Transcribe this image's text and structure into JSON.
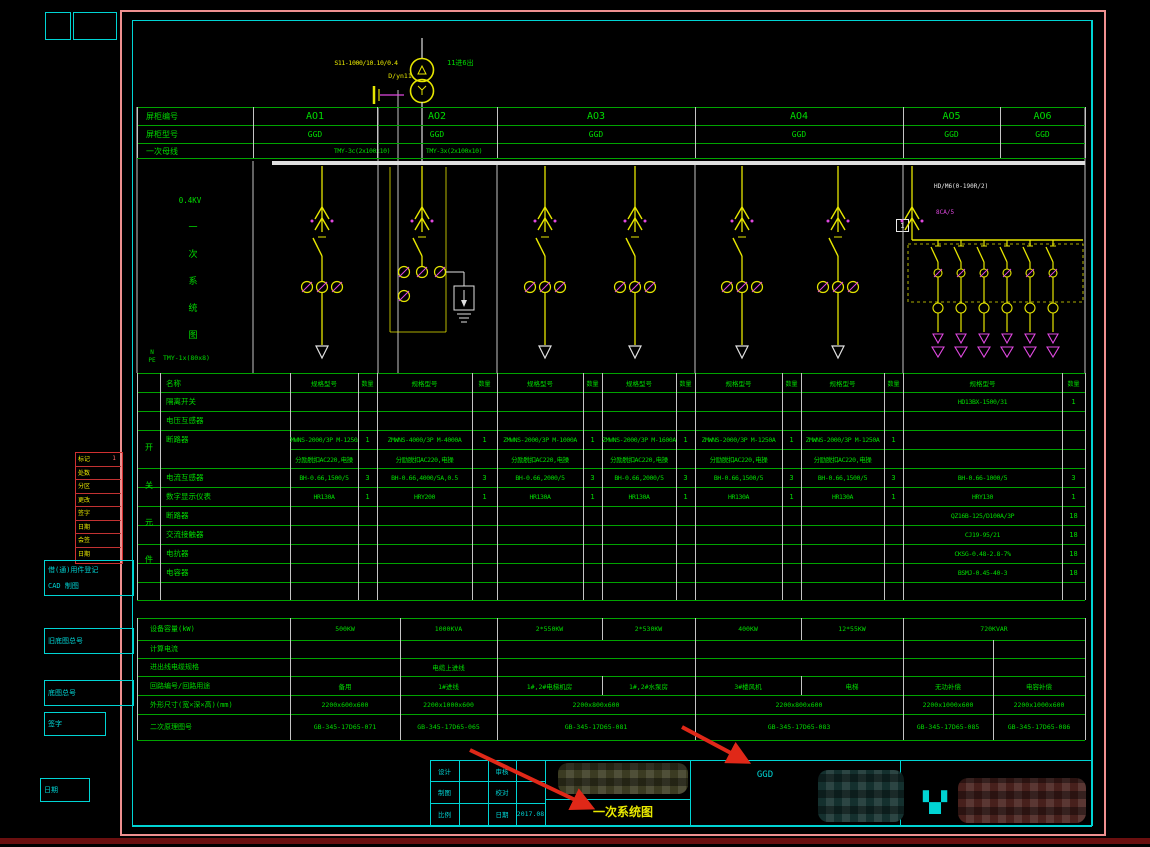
{
  "top": {
    "transformer_model": "S11-1000/10.10/0.4",
    "vector_group": "D/yn11",
    "side_note": "11进6出"
  },
  "left_labels": {
    "voltage": "0.4KV",
    "vertical_title": "一次系统图",
    "n": "N",
    "pe": "PE",
    "npe_bus": "TMY-1x(80x8)"
  },
  "header": {
    "row1_label": "屏柜编号",
    "row2_label": "屏柜型号",
    "row3_label": "一次母线",
    "panels": [
      "AO1",
      "AO2",
      "AO3",
      "AO4",
      "AO5",
      "AO6"
    ],
    "types": [
      "GGD",
      "GGD",
      "GGD",
      "GGD",
      "GGD",
      "GGD"
    ],
    "bus_label_left": "TMY-3c(2x100x10)",
    "bus_label_right": "TMY-3x(2x100x10)"
  },
  "cap_section": {
    "label_model": "HD/M6(0-190R/2)",
    "label_ct": "8CA/5",
    "box_no": "1"
  },
  "equipment": {
    "name_header": "名称",
    "spec_header": "规格型号",
    "qty_header": "数量",
    "group_chars": [
      "开",
      "关",
      "元",
      "件"
    ],
    "rows": [
      {
        "label": "隔离开关",
        "spec": [
          "",
          "",
          "",
          "",
          "",
          "",
          "HD13BX-1500/31"
        ],
        "qty": [
          "",
          "",
          "",
          "",
          "",
          "",
          "1"
        ]
      },
      {
        "label": "电压互感器",
        "spec": [
          "",
          "",
          "",
          "",
          "",
          "",
          ""
        ],
        "qty": [
          "",
          "",
          "",
          "",
          "",
          "",
          ""
        ]
      },
      {
        "label": "断路器",
        "spec": [
          "ZMWNS-2000/3P M-1250A",
          "ZMWNS-4000/3P M-4000A",
          "ZMWNS-2000/3P M-1000A",
          "ZMWNS-2000/3P M-1600A",
          "ZMWNS-2000/3P M-1250A",
          "ZMWNS-2000/3P M-1250A",
          ""
        ],
        "qty": [
          "1",
          "1",
          "1",
          "1",
          "1",
          "1",
          ""
        ]
      },
      {
        "label": "",
        "spec": [
          "分励脱扣AC220,电操",
          "分励脱扣AC220,电操",
          "分励脱扣AC220,电操",
          "分励脱扣AC220,电操",
          "分励脱扣AC220,电操",
          "分励脱扣AC220,电操",
          ""
        ],
        "qty": [
          "",
          "",
          "",
          "",
          "",
          "",
          ""
        ]
      },
      {
        "label": "电流互感器",
        "spec": [
          "BH-0.66,1500/5",
          "BH-0.66,4000/5A,0.5",
          "BH-0.66,2000/5",
          "BH-0.66,2000/5",
          "BH-0.66,1500/5",
          "BH-0.66,1500/5",
          "BH-0.66-1000/5"
        ],
        "qty": [
          "3",
          "3",
          "3",
          "3",
          "3",
          "3",
          "3"
        ]
      },
      {
        "label": "数字显示仪表",
        "spec": [
          "HR130A",
          "HRY200",
          "HR130A",
          "HR130A",
          "HR130A",
          "HR130A",
          "HRY130"
        ],
        "qty": [
          "1",
          "1",
          "1",
          "1",
          "1",
          "1",
          "1"
        ]
      },
      {
        "label": "断路器",
        "spec": [
          "",
          "",
          "",
          "",
          "",
          "",
          "QZ16B-125/D100A/3P"
        ],
        "qty": [
          "",
          "",
          "",
          "",
          "",
          "",
          "18"
        ]
      },
      {
        "label": "交流接触器",
        "spec": [
          "",
          "",
          "",
          "",
          "",
          "",
          "CJ19-95/21"
        ],
        "qty": [
          "",
          "",
          "",
          "",
          "",
          "",
          "18"
        ]
      },
      {
        "label": "电抗器",
        "spec": [
          "",
          "",
          "",
          "",
          "",
          "",
          "CKSG-0.48-2.8-7%"
        ],
        "qty": [
          "",
          "",
          "",
          "",
          "",
          "",
          "18"
        ]
      },
      {
        "label": "电容器",
        "spec": [
          "",
          "",
          "",
          "",
          "",
          "",
          "BSMJ-0.45-40-3"
        ],
        "qty": [
          "",
          "",
          "",
          "",
          "",
          "",
          "18"
        ]
      },
      {
        "label": "",
        "spec": [
          "",
          "",
          "",
          "",
          "",
          "",
          ""
        ],
        "qty": [
          "",
          "",
          "",
          "",
          "",
          "",
          ""
        ]
      }
    ]
  },
  "summary": {
    "rows": [
      {
        "label": "设备容量(kW)",
        "cells": [
          [
            "A1",
            "500KW"
          ],
          [
            "A2",
            "1000KVA"
          ],
          [
            "A3a",
            "2*550KW"
          ],
          [
            "A3b",
            "2*530KW"
          ],
          [
            "A4a",
            "400KW"
          ],
          [
            "A4b",
            "12*55KW"
          ],
          [
            "A56",
            "720KVAR"
          ]
        ]
      },
      {
        "label": "计算电流",
        "cells": []
      },
      {
        "label": "进出线电缆规格",
        "cells": [
          [
            "A2",
            "电缆上进线"
          ]
        ]
      },
      {
        "label": "回路编号/回路用途",
        "cells": [
          [
            "A1",
            "备用"
          ],
          [
            "A2",
            "1#进线"
          ],
          [
            "A3a",
            "1#,2#电梯机房"
          ],
          [
            "A3b",
            "1#,2#水泵房"
          ],
          [
            "A4a",
            "3#楼风机"
          ],
          [
            "A4b",
            "电梯"
          ],
          [
            "A5",
            "无功补偿"
          ],
          [
            "A6",
            "电容补偿"
          ]
        ]
      },
      {
        "label": "外形尺寸(宽×深×高)(mm)",
        "cells": [
          [
            "A1",
            "2200x600x600"
          ],
          [
            "A2",
            "2200x1000x600"
          ],
          [
            "A3",
            "2200x800x600"
          ],
          [
            "A4",
            "2200x800x600"
          ],
          [
            "A5",
            "2200x1000x600"
          ],
          [
            "A6",
            "2200x1000x600"
          ]
        ]
      },
      {
        "label": "二次原理图号",
        "cells": [
          [
            "A1",
            "GB-345-17D65-071"
          ],
          [
            "A2",
            "GB-345-17D65-065"
          ],
          [
            "A3",
            "GB-345-17D65-081"
          ],
          [
            "A4",
            "GB-345-17D65-083"
          ],
          [
            "A5",
            "GB-345-17D65-085"
          ],
          [
            "A6",
            "GB-345-17D65-086"
          ]
        ]
      }
    ]
  },
  "title_block": {
    "mini_rows": [
      [
        "设计",
        "",
        "审核",
        ""
      ],
      [
        "制图",
        "",
        "校对",
        ""
      ],
      [
        "比例",
        "",
        "日期",
        "2017.08"
      ]
    ],
    "drawing_name": "一次系统图",
    "panel_type": "GGD"
  },
  "left_margin": {
    "revision_rows": [
      [
        "标记",
        "1"
      ],
      [
        "处数",
        ""
      ],
      [
        "分区",
        ""
      ],
      [
        "更改",
        ""
      ],
      [
        "签字",
        ""
      ],
      [
        "日期",
        ""
      ],
      [
        "会签",
        ""
      ],
      [
        "日期",
        ""
      ]
    ],
    "block1_line1": "借(通)用件登记",
    "block1_line2": "CAD 制图",
    "block2": "旧底图总号",
    "block3": "底图总号",
    "block4": "签字",
    "block5": "日期"
  }
}
